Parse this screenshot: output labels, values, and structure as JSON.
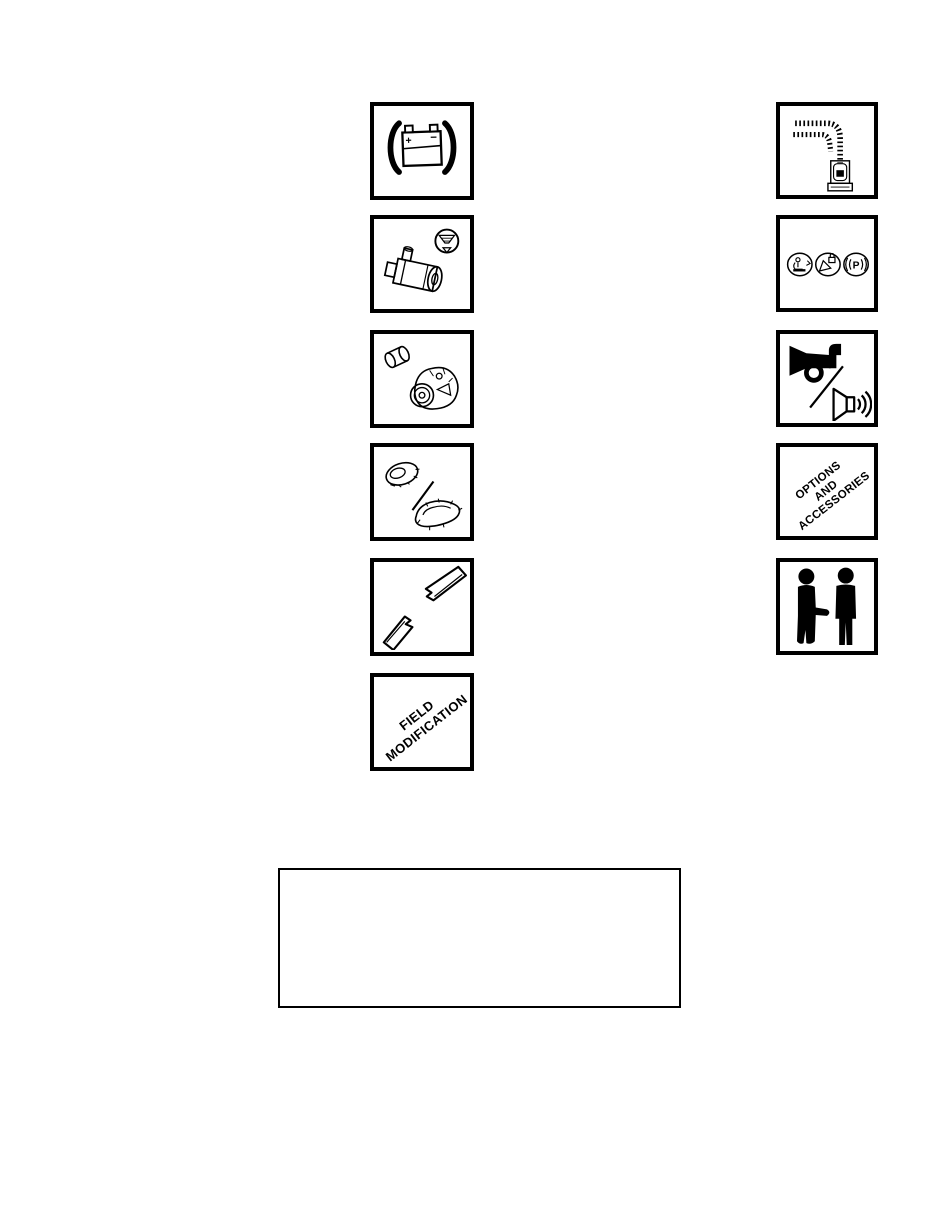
{
  "page": {
    "background_color": "#ffffff",
    "ink_color": "#000000",
    "kind": "manual-section-icon-page"
  },
  "icon_grid": {
    "left_column": [
      {
        "name": "battery",
        "icon": "battery-icon",
        "plus_label": "+",
        "minus_label": "−"
      },
      {
        "name": "starter-motor",
        "icon": "starter-motor-icon"
      },
      {
        "name": "alternator",
        "icon": "alternator-icon"
      },
      {
        "name": "tires-and-tracks",
        "icon": "tire-track-icon"
      },
      {
        "name": "drive-belt",
        "icon": "torn-belt-icon"
      },
      {
        "name": "field-modification",
        "lines": [
          "FIELD",
          "MODIFICATION"
        ]
      }
    ],
    "right_column": [
      {
        "name": "wiring-harness",
        "icon": "wiring-harness-icon"
      },
      {
        "name": "indicator-symbols",
        "icon": "indicator-lights-icon",
        "parking_label": "P"
      },
      {
        "name": "horn-and-alarm",
        "icon": "horn-speaker-icon"
      },
      {
        "name": "options-and-accessories",
        "lines": [
          "OPTIONS",
          "AND",
          "ACCESSORIES"
        ]
      },
      {
        "name": "personnel",
        "icon": "two-persons-icon"
      }
    ]
  },
  "notes_box": {
    "text": ""
  }
}
